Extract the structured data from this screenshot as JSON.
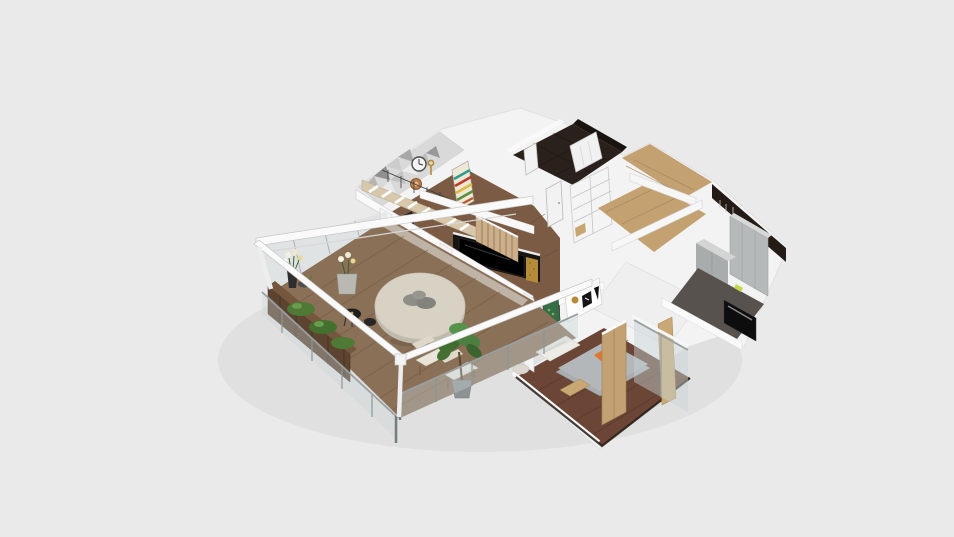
{
  "meta": {
    "description": "3D dollhouse-style isometric floor plan render of an apartment, shown centered on a plain light-gray canvas with no visible UI chrome",
    "view": "orbit 3d cutaway view",
    "visible_text": []
  },
  "viewport": {
    "width": 954,
    "height": 537
  },
  "scene": {
    "rooms": [
      "balcony-terrace",
      "living-dining-room",
      "hallway",
      "wardrobe-closet",
      "bathroom",
      "kitchen",
      "bedroom"
    ],
    "objects": [
      "pergola-beams",
      "glass-railing",
      "wood-planters",
      "flower-vases",
      "round-dining-table",
      "outdoor-chairs",
      "black-side-tables",
      "potted-plant",
      "white-staircase",
      "upper-staircase",
      "triangle-accent-wall",
      "wall-clocks",
      "gold-key-decor",
      "striped-artwork",
      "tv-media-wall",
      "gold-panels",
      "wood-slat-partition",
      "interior-doors",
      "wardrobe-shelves",
      "white-wardrobe",
      "kitchen-cabinets",
      "kitchen-counter",
      "oven",
      "double-bed",
      "orange-pillows",
      "wood-partition",
      "bedroom-glass-wall",
      "wall-art-frames",
      "lounge-chair"
    ],
    "colors": {
      "background": "#eaeaea",
      "house_white": "#f3f3f3",
      "wall_bright": "#fbfbfb",
      "deck_wood": "#8a7057",
      "living_wood": "#7c5b44",
      "hallway_wood": "#c4a171",
      "bedroom_wood": "#6b4637",
      "dark_tile": "#2a211d",
      "dark_wall": "#241b16",
      "kitchen_cabinet": "#b5b9b9",
      "kitchen_floor": "#57524d",
      "appliance_black": "#0d0d0d",
      "accent_wall": "#d9d9d9",
      "gold": "#b68b35",
      "tv_black": "#171512",
      "slat_wood": "#cdb08b",
      "stair_stringer": "#d8c8ab",
      "stair_white": "#efede8",
      "table_top": "#d8d2c4",
      "planter_wood": "#5d4430",
      "plant_green": "#4e7a36",
      "glass": "#c8d4d7",
      "railing_metal": "#9aa0a0",
      "beam_white": "#fafafa",
      "bed_gray": "#a9adb0",
      "bed_orange": "#e0762c",
      "partition_wood": "#c4a173",
      "frame_green": "#356e46",
      "door_white": "#f2f2f2",
      "art_teal": "#2a9d8f",
      "art_red": "#c0392b",
      "art_yellow": "#e0b93f",
      "art_green": "#5a8f3c"
    }
  }
}
